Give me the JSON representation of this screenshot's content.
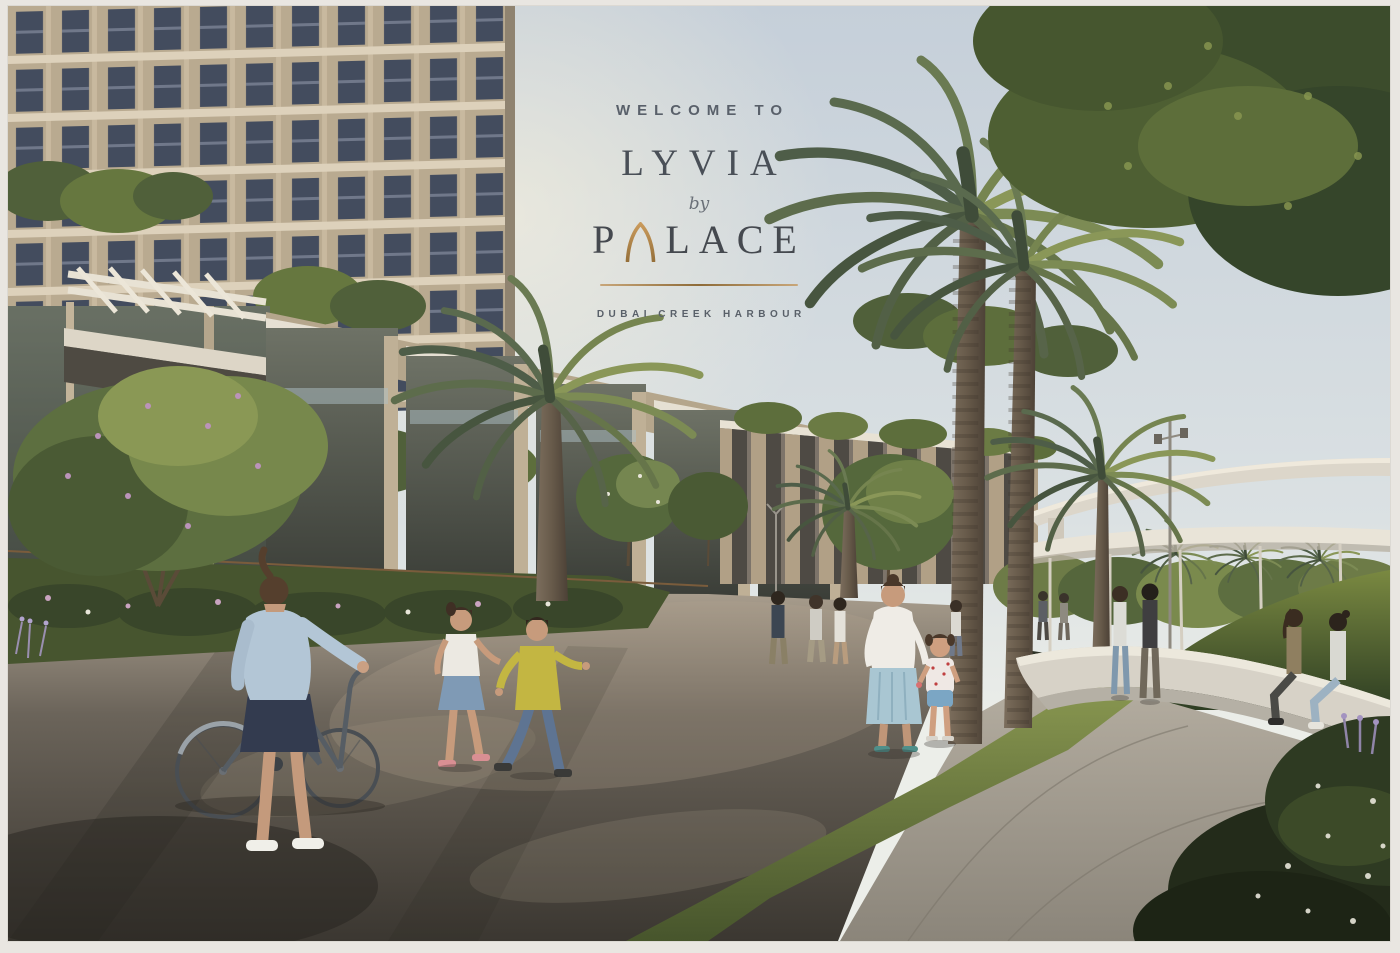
{
  "overlay": {
    "welcome": "WELCOME TO",
    "brand": "LYVIA",
    "by": "by",
    "palace_first": "P",
    "palace_rest": "LACE",
    "palace_full": "PALACE",
    "tagline": "DUBAI CREEK HARBOUR"
  },
  "colors": {
    "gold_accent": "#a87c42",
    "heading_gray": "#4b525a",
    "sky_top": "#c5cfd9",
    "building_beige": "#b9aa90",
    "window_glass": "#465061",
    "foliage_green": "#4a5a33",
    "pavement_dark": "#45413a",
    "walkway_light": "#a49d91",
    "bench_white": "#d7d2c7",
    "frame_border": "#f1efea"
  },
  "scene": {
    "description": "Sunlit render of a residential promenade: beige tower and glass townhouses on the left, tall date palms along a curved walkway, pedestrians strolling, a woman walking a bicycle, children running, a mother with her daughter, a curved white bench with two seated women, a shade canopy and elevated road in the distance, and an overhanging tree at the top right.",
    "elements": [
      "residential-tower",
      "townhouse-row",
      "date-palms",
      "promenade",
      "grass-strip",
      "curved-bench",
      "shade-canopy",
      "elevated-road",
      "green-hill",
      "pedestrians",
      "woman-with-bicycle",
      "children",
      "mother-and-child",
      "seated-women",
      "overhanging-tree",
      "lamp-posts",
      "flower-beds"
    ]
  }
}
